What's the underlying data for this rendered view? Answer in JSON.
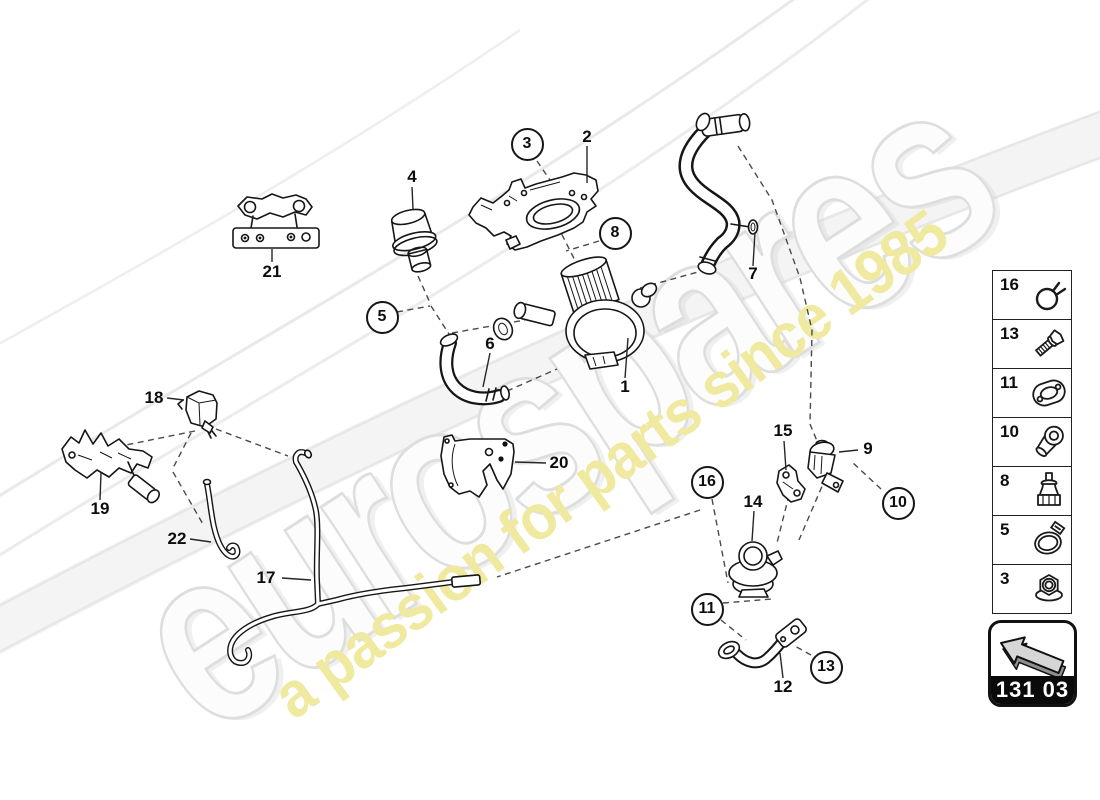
{
  "watermark": {
    "brand": "eurospares",
    "tagline": "a passion for parts since 1985"
  },
  "diagram": {
    "part_labels": {
      "l1": "1",
      "l2": "2",
      "l3": "3",
      "l4": "4",
      "l5": "5",
      "l6": "6",
      "l7": "7",
      "l8": "8",
      "l9": "9",
      "l10": "10",
      "l11": "11",
      "l12": "12",
      "l13": "13",
      "l14": "14",
      "l15": "15",
      "l16": "16",
      "l17": "17",
      "l18": "18",
      "l19": "19",
      "l20": "20",
      "l21": "21",
      "l22": "22"
    }
  },
  "sidebar": {
    "items": [
      {
        "num": "16",
        "icon": "hose-clip-icon"
      },
      {
        "num": "13",
        "icon": "flange-bolt-icon"
      },
      {
        "num": "11",
        "icon": "gasket-icon"
      },
      {
        "num": "10",
        "icon": "stud-bushing-icon"
      },
      {
        "num": "8",
        "icon": "rubber-mount-icon"
      },
      {
        "num": "5",
        "icon": "hose-clamp-icon"
      },
      {
        "num": "3",
        "icon": "flange-nut-icon"
      }
    ]
  },
  "footer_box": {
    "code": "131 03"
  }
}
